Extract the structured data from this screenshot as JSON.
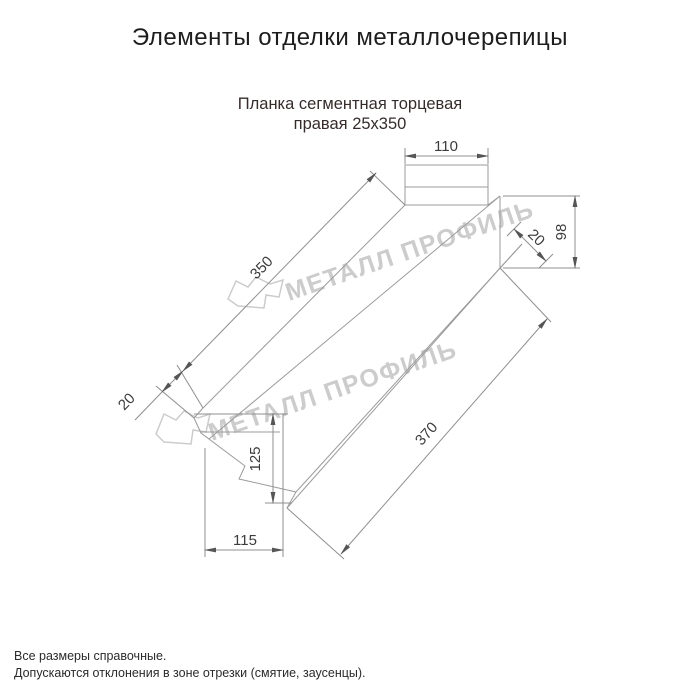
{
  "page": {
    "title": "Элементы отделки металлочерепицы"
  },
  "product": {
    "name_line1": "Планка сегментная торцевая",
    "name_line2": "правая 25х350"
  },
  "drawing": {
    "type": "technical-drawing",
    "dims": {
      "top_flange_width": "110",
      "main_face_length": "350",
      "left_end_fold": "20",
      "end_height": "98",
      "right_end_fold": "20",
      "cut_height": "125",
      "cut_width": "115",
      "bottom_edge_length": "370"
    }
  },
  "watermark": {
    "text": "МЕТАЛЛ ПРОФИЛЬ"
  },
  "footer": {
    "line1": "Все размеры справочные.",
    "line2": "Допускаются отклонения в зоне отрезки (смятие, заусенцы)."
  },
  "colors": {
    "line": "#9b9b9b",
    "dimension_text": "#3c3c3c",
    "watermark": "#cccccc",
    "text": "#1d1d1d"
  }
}
